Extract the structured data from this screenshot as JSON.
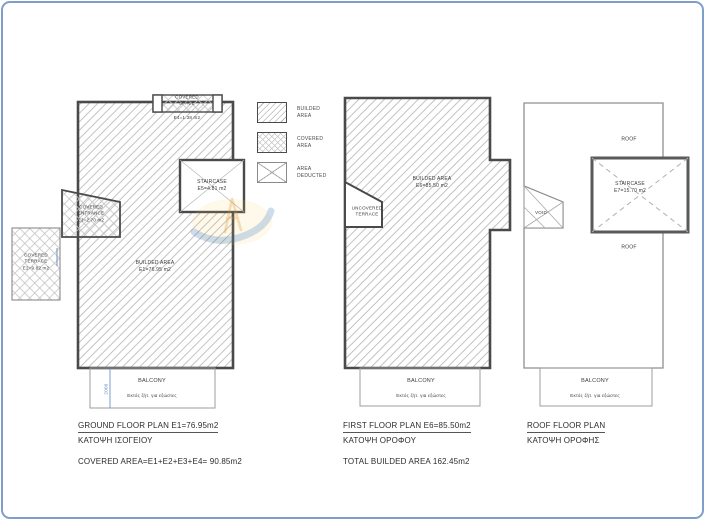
{
  "colors": {
    "frame": "#7d9fc9",
    "outline": "#4a4a4a",
    "hatch": "#bcbcbc",
    "dim-blue": "#5b85c2",
    "text": "#3a3a3a"
  },
  "legend": {
    "items": [
      {
        "label": "BUILDED\nAREA",
        "pattern": "diagonal-hatch"
      },
      {
        "label": "COVERED\nAREA",
        "pattern": "cross-hatch"
      },
      {
        "label": "AREA\nDEDUCTED",
        "pattern": "x-cross"
      }
    ]
  },
  "ground_plan": {
    "covered_space_label": "COVERED\nSPACE",
    "covered_space_area": "E4=1.38 m2",
    "staircase_label": "STAIRCASE\nE5=4.81 m2",
    "covered_entrance_label": "COVERED\nENTRANCE\nE3=2.70 m2",
    "covered_terrace_label": "COVERED\nTERRACE\nE2=9.82 m2",
    "builded_area_label": "BUILDED AREA\nE1=76.95 m2",
    "balcony_label": "BALCONY",
    "balcony_note": "Εκτός ζήτ. για εξώστες",
    "balcony_dim": "2000",
    "title": "GROUND FLOOR PLAN E1=76.95m2",
    "subtitle": "ΚΑΤΟΨΗ ΙΣΟΓΕΙΟΥ",
    "note": "COVERED AREA=E1+E2+E3+E4= 90.85m2"
  },
  "first_floor_plan": {
    "builded_area_label": "BUILDED AREA\nE6=85.50 m2",
    "uncovered_terrace_label": "UNCOVERED\nTERRACE",
    "balcony_label": "BALCONY",
    "balcony_note": "Εκτός ζήτ. για εξώστες",
    "title": "FIRST FLOOR PLAN E6=85.50m2",
    "subtitle": "ΚΑΤΟΨΗ ΟΡΟΦΟΥ",
    "note": "TOTAL BUILDED AREA 162.45m2"
  },
  "roof_plan": {
    "roof_label_top": "ROOF",
    "roof_label_bottom": "ROOF",
    "staircase_label": "STAIRCASE\nE7=15.70 m2",
    "void_label": "VOID",
    "balcony_label": "BALCONY",
    "balcony_note": "Εκτός ζήτ. για εξώστες",
    "title": "ROOF FLOOR PLAN",
    "subtitle": "ΚΑΤΟΨΗ ΟΡΟΦΗΣ"
  },
  "watermark": {
    "icon": "compass-swoosh-logo"
  }
}
